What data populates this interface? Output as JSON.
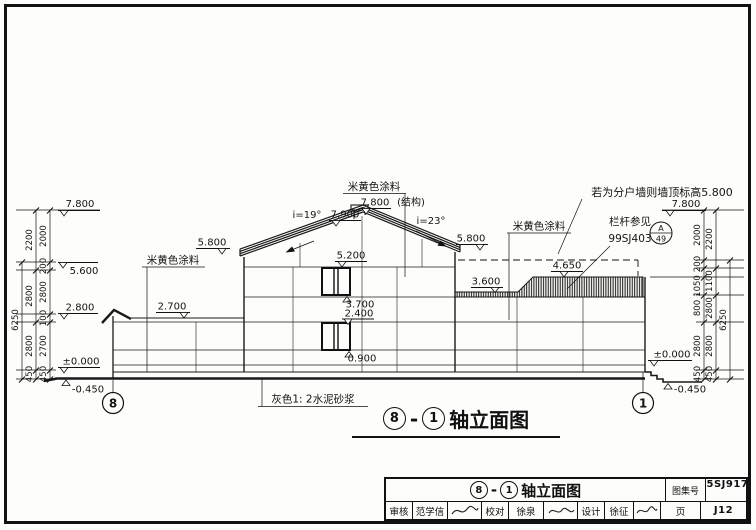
{
  "levels": {
    "v780": "7.800",
    "v790": "7.900",
    "v780_suffix": "(结构)",
    "v580": "5.800",
    "v560": "5.600",
    "v520": "5.200",
    "v465": "4.650",
    "v370": "3.700",
    "v360": "3.600",
    "v280": "2.800",
    "v270": "2.700",
    "v240": "2.400",
    "v090": "0.900",
    "v000": "±0.000",
    "vm045": "-0.450"
  },
  "dims": {
    "d6250": "6250",
    "d2800": "2800",
    "d2700": "2700",
    "d2200": "2200",
    "d2000": "2000",
    "d1100": "1100",
    "d1050": "1050",
    "d800": "800",
    "d450": "450",
    "d200": "200",
    "d100": "100"
  },
  "slopes": {
    "left": "i=19°",
    "right": "i=23°"
  },
  "axes": {
    "start": "8",
    "end": "1"
  },
  "annotations": {
    "paint": "米黄色涂料",
    "party_wall": "若为分户墙则墙顶标高5.800",
    "railing_line1": "栏杆参见",
    "railing_line2": "99SJ403",
    "detail_letter": "A",
    "detail_number": "49",
    "plinth": "灰色1: 2水泥砂浆"
  },
  "caption": {
    "axis_start": "8",
    "separator": "-",
    "axis_end": "1",
    "text": "轴立面图"
  },
  "titleblock": {
    "axis_start": "8",
    "separator": "-",
    "axis_end": "1",
    "title_text": "轴立面图",
    "atlas_label": "图集号",
    "atlas_no": "05SJ917-1",
    "page_label": "页",
    "page_no": "J12",
    "review_label": "审核",
    "reviewer": "范学信",
    "proof_label": "校对",
    "proofer": "徐泉",
    "design_label": "设计",
    "designer": "徐征"
  }
}
